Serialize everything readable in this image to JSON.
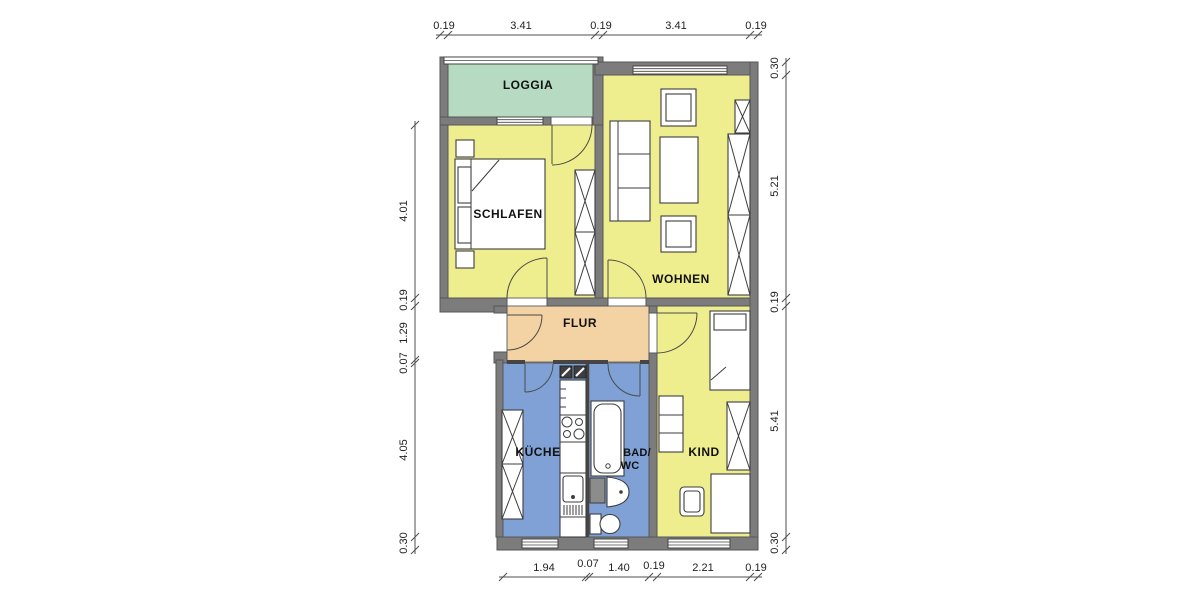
{
  "palette": {
    "wall": "#7c7c7c",
    "thin_wall": "#454545",
    "room_yellow": "#efee8e",
    "loggia_green": "#b6dbc2",
    "flur_tan": "#f3d2a3",
    "wet_blue": "#7fa1d5",
    "appliance_gray": "#8c8c8c",
    "background": "#ffffff"
  },
  "rooms": {
    "loggia": {
      "label": "LOGGIA"
    },
    "schlafen": {
      "label": "SCHLAFEN"
    },
    "wohnen": {
      "label": "WOHNEN"
    },
    "flur": {
      "label": "FLUR"
    },
    "kueche": {
      "label": "KÜCHE"
    },
    "bad": {
      "label_line1": "BAD/",
      "label_line2": "WC"
    },
    "kind": {
      "label": "KIND"
    }
  },
  "dimensions": {
    "top": [
      "0.19",
      "3.41",
      "0.19",
      "3.41",
      "0.19"
    ],
    "right": [
      "0.30",
      "5.21",
      "0.19",
      "5.41",
      "0.30"
    ],
    "left": [
      "4.01",
      "0.19",
      "1.29",
      "0.07",
      "4.05",
      "0.30"
    ],
    "bottom": [
      "1.94",
      "0.07",
      "1.40",
      "0.19",
      "2.21",
      "0.19"
    ]
  }
}
